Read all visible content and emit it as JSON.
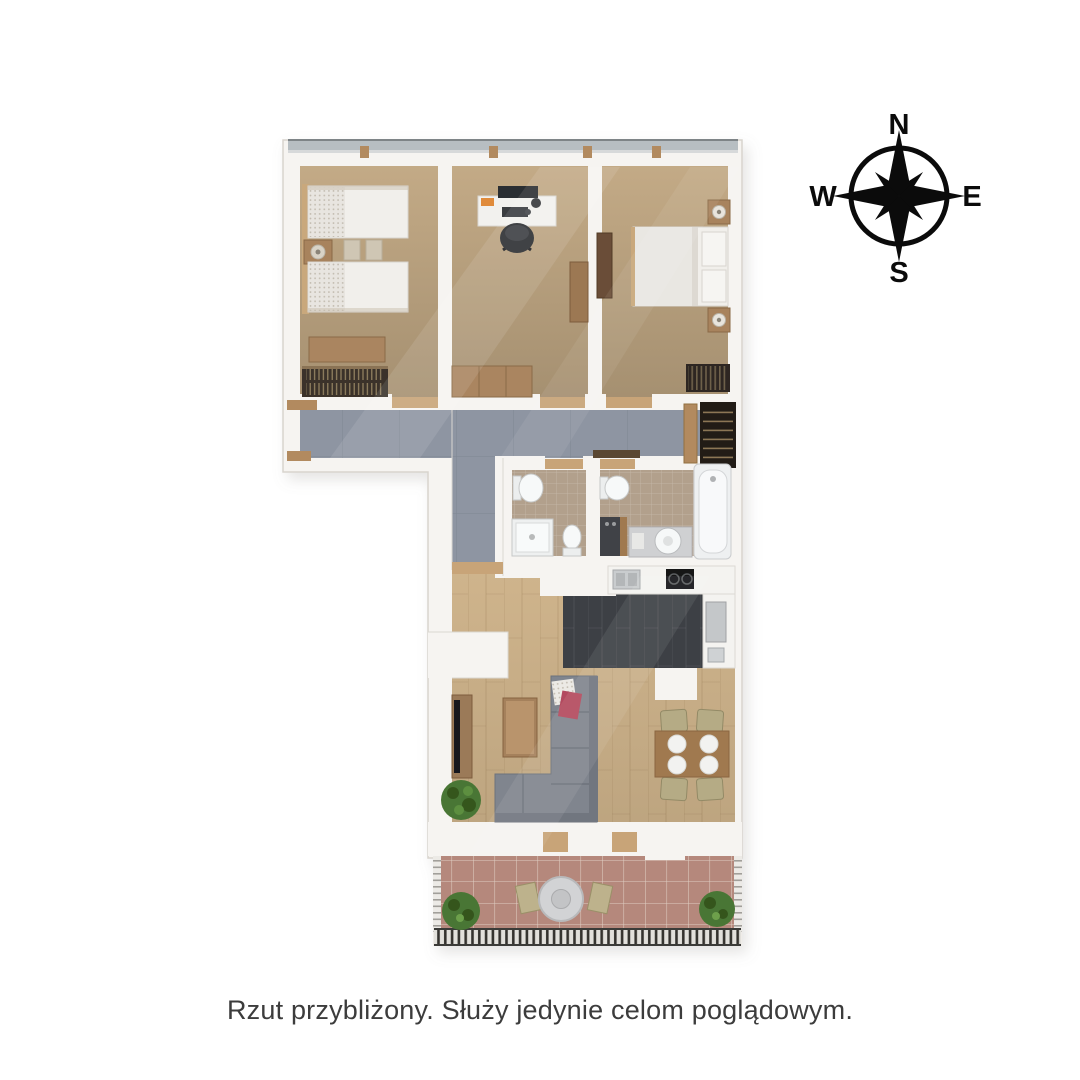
{
  "caption": {
    "text": "Rzut przybliżony. Służy jedynie celom poglądowym.",
    "color": "#3c3c3c"
  },
  "compass": {
    "color": "#000000",
    "labels": {
      "north": "N",
      "east": "E",
      "south": "S",
      "west": "W"
    }
  },
  "floor_plan": {
    "colors": {
      "wall": "#f6f4f1",
      "wall_edge": "#d8d4ce",
      "bedroom_carpet": "#c3aa86",
      "hallway_tile": "#8e95a2",
      "bathroom_tile": "#b2a08c",
      "wood_floor": "#cfb48c",
      "kitchen_floor": "#3d4045",
      "terrace_tile": "#b5887b",
      "furniture_wood": "#a5815c",
      "dark_wardrobe": "#3a322a",
      "sofa": "#80858e",
      "bedding": "#f1efeb",
      "plant": "#4a7636",
      "window_glass": "#b7bec2",
      "bathtub": "#eef0f1"
    }
  }
}
